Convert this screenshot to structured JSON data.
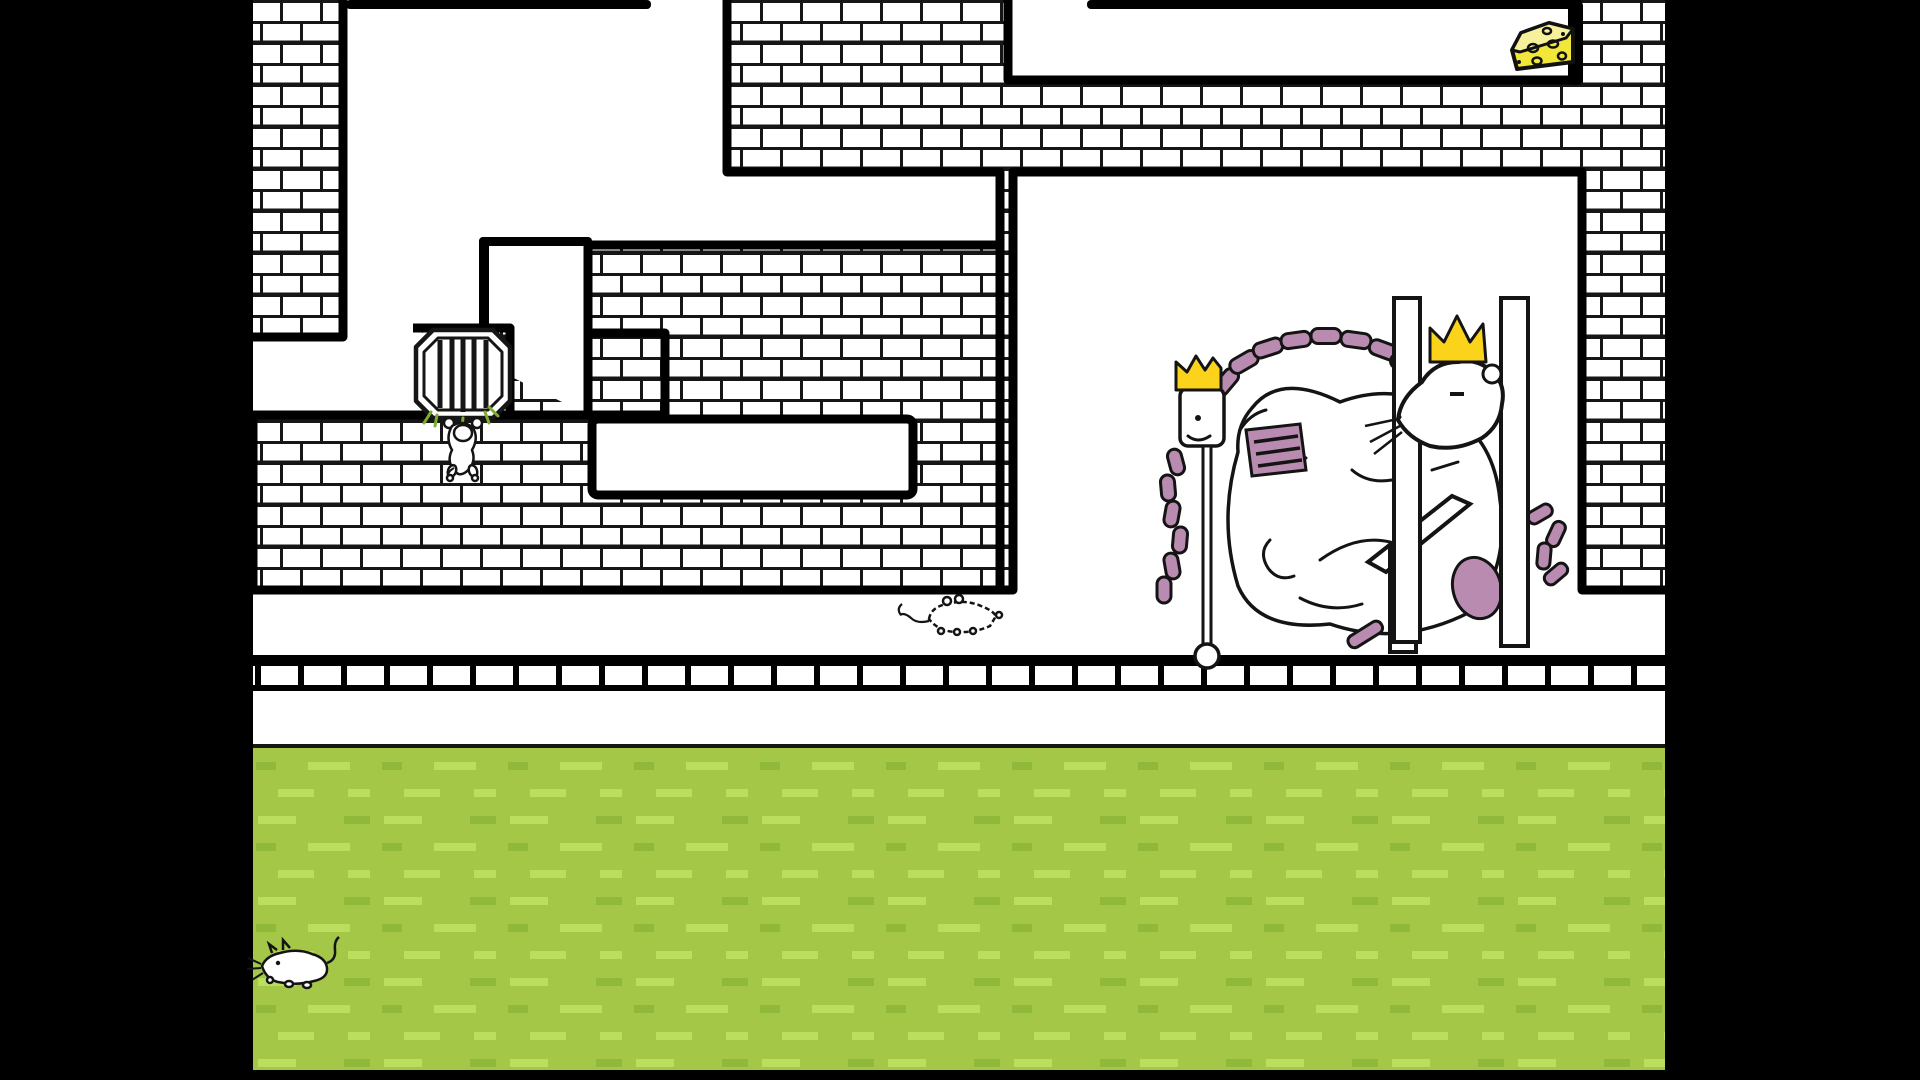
{
  "scene": {
    "type": "pixel-art game scene",
    "description": "black-and-white brick maze with cheese goal, vent grate, mice, and two crowned rats sleeping in a bedroom above a grass field"
  },
  "colors": {
    "letterbox": "#000000",
    "background_white": "#ffffff",
    "wall_line": "#111111",
    "grass_base": "#a5c748",
    "grass_dash_light": "#bbde5f",
    "grass_dash_dark": "#90b83a",
    "grass_edge": "#161616",
    "crown_gold": "#fcd31b",
    "cheese_yellow": "#f1e73b",
    "cheese_top": "#f8f19b",
    "rat_pink": "#b98bb0",
    "sprig_green": "#7fae2e"
  },
  "entities": {
    "cheese": {
      "label": "cheese wedge with holes",
      "location": "end of top-right corridor"
    },
    "vent_grate": {
      "label": "octagonal vent grate with bars",
      "location": "brick alcove, mid-left"
    },
    "grate_mouse": {
      "label": "white mouse hanging from grate"
    },
    "floor_mouse": {
      "label": "white mouse walking on floor toward bedroom"
    },
    "grass_mouse": {
      "label": "white mouse lying in grass",
      "location": "bottom-left"
    },
    "rat_king": {
      "label": "two crowned rats asleep on bed with tangled pink tails",
      "crowns": 2,
      "parts": [
        "small crowned figure with scepter",
        "large crowned rat",
        "bedposts",
        "bed rail",
        "pink tail coils"
      ]
    },
    "maze_walls": {
      "label": "white brick walls with black mortar joints"
    },
    "ledge": {
      "label": "row of flat bricks under floor line"
    },
    "grass": {
      "label": "grass field with dash texture"
    }
  }
}
